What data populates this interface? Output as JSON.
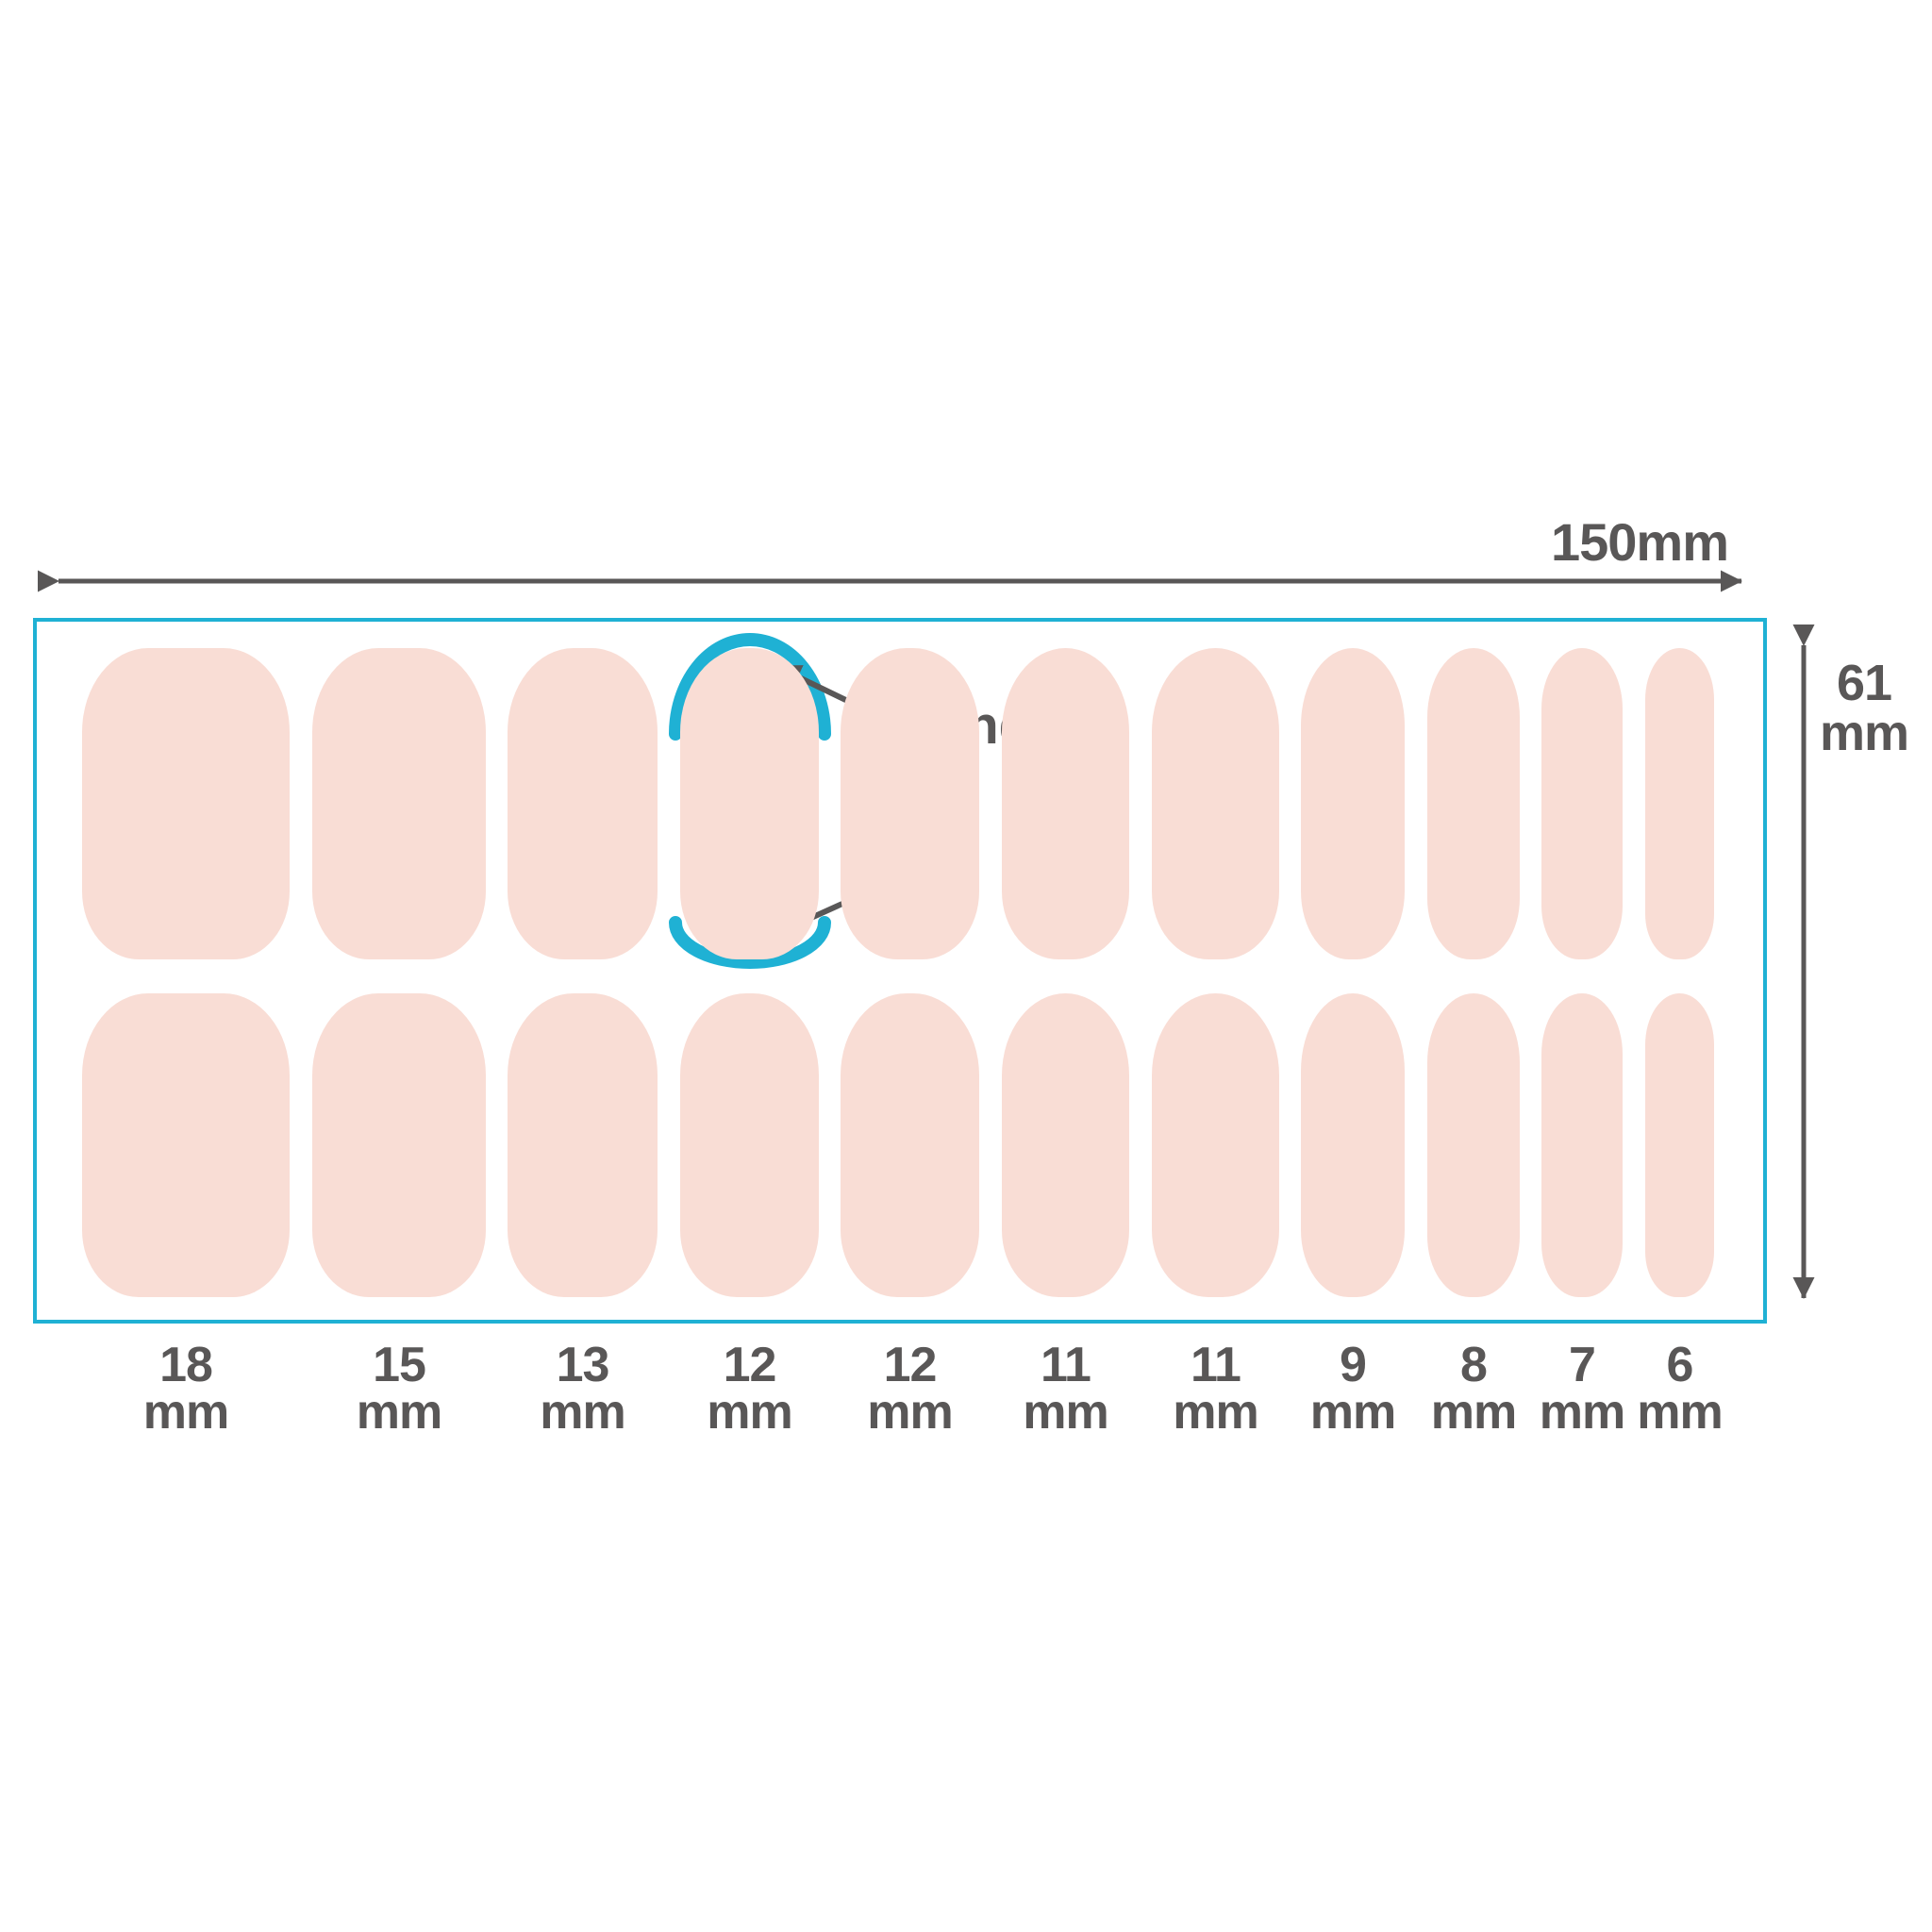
{
  "diagram": {
    "title_semantic": "nail sticker sheet size guide",
    "sheet_width_label": "150mm",
    "sheet_height": {
      "value": "61",
      "unit": "mm"
    },
    "nail_length": {
      "value": "27",
      "unit": "mm"
    },
    "tip_labels": {
      "round": "round",
      "flat": "flat"
    },
    "sheet_width_mm": 150,
    "sheet_height_mm": 61,
    "nail_length_mm": 27
  },
  "columns": [
    {
      "size": "18",
      "unit": "mm",
      "mm": 18
    },
    {
      "size": "15",
      "unit": "mm",
      "mm": 15
    },
    {
      "size": "13",
      "unit": "mm",
      "mm": 13
    },
    {
      "size": "12",
      "unit": "mm",
      "mm": 12
    },
    {
      "size": "12",
      "unit": "mm",
      "mm": 12
    },
    {
      "size": "11",
      "unit": "mm",
      "mm": 11
    },
    {
      "size": "11",
      "unit": "mm",
      "mm": 11
    },
    {
      "size": "9",
      "unit": "mm",
      "mm": 9
    },
    {
      "size": "8",
      "unit": "mm",
      "mm": 8
    },
    {
      "size": "7",
      "unit": "mm",
      "mm": 7
    },
    {
      "size": "6",
      "unit": "mm",
      "mm": 6
    }
  ],
  "colors": {
    "nail": "#f9ddd5",
    "accent": "#1fb1d4",
    "text": "#595757"
  }
}
